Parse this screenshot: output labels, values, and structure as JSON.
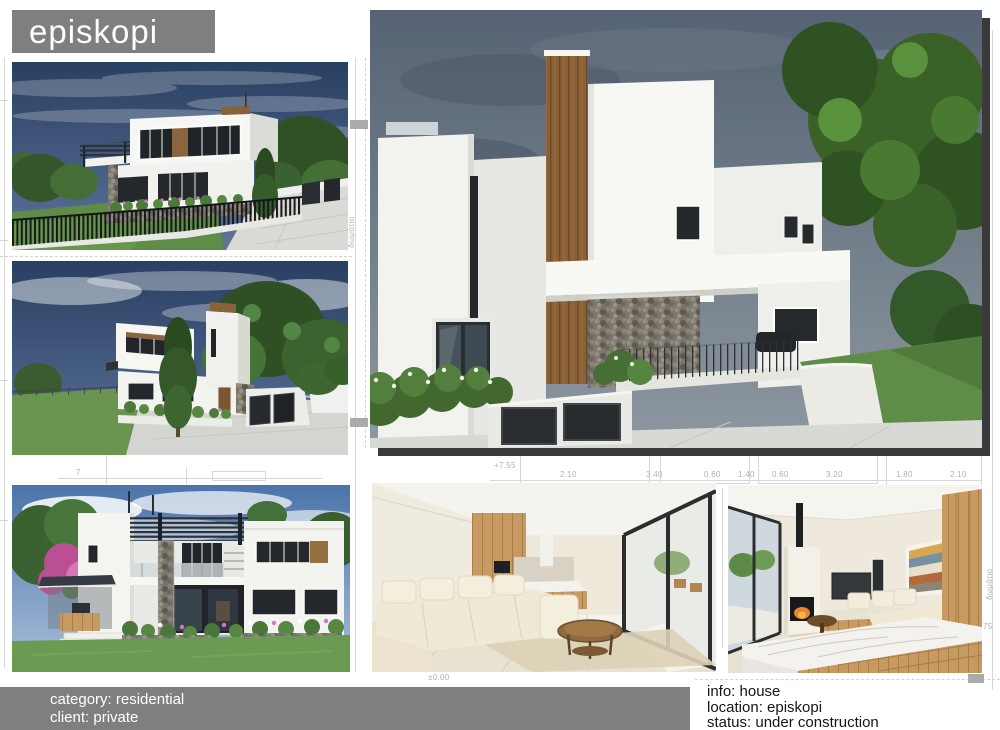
{
  "page_title": "episkopi",
  "footer": {
    "category": "category: residential",
    "client": "client: private"
  },
  "project_info": {
    "info": "info: house",
    "location": "location: episkopi",
    "status": "status: under construction"
  },
  "blueprint": {
    "level_upper": "+7.55",
    "level_zero": "±0.00",
    "dims": [
      "2.10",
      "3.40",
      "0.60",
      "1.40",
      "0.60",
      "3.20",
      "1.80",
      "2.10"
    ],
    "grid_left": "7",
    "grid_right": "75",
    "room_label": "δωμάτιο"
  },
  "renders": {
    "exterior_corner": {
      "label": "exterior render - street corner view"
    },
    "exterior_side": {
      "label": "exterior render - side street view"
    },
    "exterior_main": {
      "label": "main exterior render - entrance view"
    },
    "exterior_garden": {
      "label": "exterior render - garden facade with pergola"
    },
    "interior_living": {
      "label": "interior render - living room and kitchen"
    },
    "interior_lounge": {
      "label": "interior render - lounge with fireplace"
    }
  },
  "colors": {
    "banner_gray": "#7f7f7f",
    "footer_gray": "#7f7f7f",
    "shadow_dark": "#3a3a3a",
    "info_text": "#151515"
  }
}
